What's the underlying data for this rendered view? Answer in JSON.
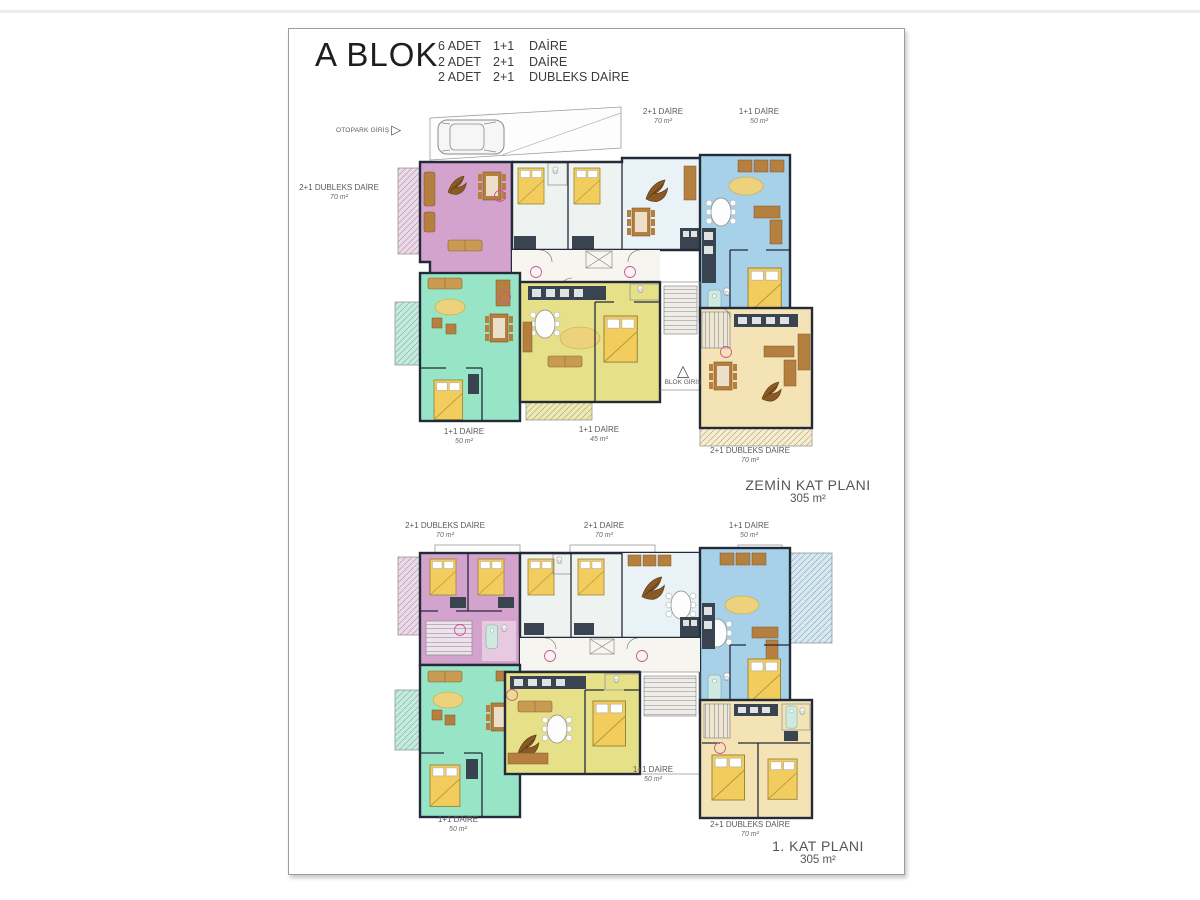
{
  "header": {
    "block_title": "A BLOK",
    "summary": [
      {
        "count": "6 ADET",
        "layout": "1+1",
        "kind": "DAİRE"
      },
      {
        "count": "2 ADET",
        "layout": "2+1",
        "kind": "DAİRE"
      },
      {
        "count": "2 ADET",
        "layout": "2+1",
        "kind": "DUBLEKS DAİRE"
      }
    ]
  },
  "ground_floor": {
    "plan_name": "ZEMİN KAT PLANI",
    "plan_area": "305 m²",
    "otopark_label": "OTOPARK GİRİŞ",
    "blok_giris_label": "BLOK GİRİŞ",
    "labels": {
      "left_dubleks": {
        "name": "2+1 DUBLEKS DAİRE",
        "area": "70 m²"
      },
      "top_2plus1": {
        "name": "2+1 DAİRE",
        "area": "70 m²"
      },
      "top_1plus1": {
        "name": "1+1 DAİRE",
        "area": "50 m²"
      },
      "bottom_1plus1_a": {
        "name": "1+1 DAİRE",
        "area": "50 m²"
      },
      "bottom_1plus1_b": {
        "name": "1+1 DAİRE",
        "area": "45 m²"
      },
      "bottom_dubleks": {
        "name": "2+1 DUBLEKS DAİRE",
        "area": "70 m²"
      }
    }
  },
  "first_floor": {
    "plan_name": "1. KAT PLANI",
    "plan_area": "305 m²",
    "labels": {
      "top_dubleks": {
        "name": "2+1 DUBLEKS DAİRE",
        "area": "70 m²"
      },
      "top_2plus1": {
        "name": "2+1 DAİRE",
        "area": "70 m²"
      },
      "top_1plus1": {
        "name": "1+1 DAİRE",
        "area": "50 m²"
      },
      "mid_1plus1": {
        "name": "1+1 DAİRE",
        "area": "50 m²"
      },
      "bottom_1plus1": {
        "name": "1+1 DAİRE",
        "area": "50 m²"
      },
      "bottom_dubleks": {
        "name": "2+1 DUBLEKS DAİRE",
        "area": "70 m²"
      }
    }
  },
  "palette": {
    "dubleks_pink": "#d4a3cd",
    "unit_green": "#97e4c7",
    "unit_yellow": "#e6e088",
    "unit_blue": "#a6d1e9",
    "dubleks_tan": "#f4e3b5",
    "wall_dark": "#232b38",
    "bed_yellow": "#f2cd5e"
  }
}
